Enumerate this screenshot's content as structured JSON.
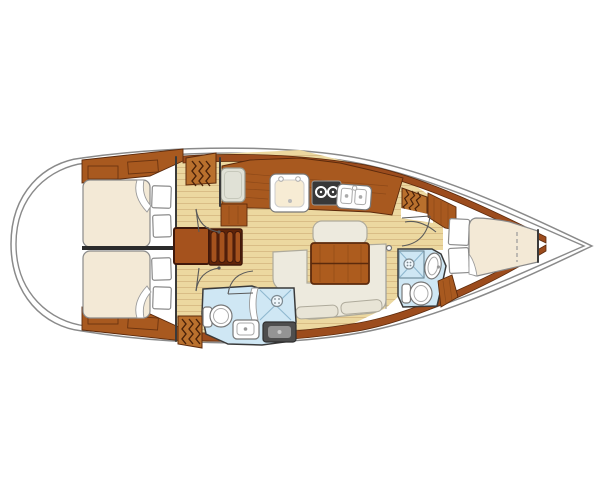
{
  "diagram": {
    "kind": "sailboat-interior-floor-plan",
    "orientation": "bow-right",
    "rooms": [
      {
        "name": "aft-cabin-port",
        "features": [
          "double-berth",
          "pillows",
          "hanging-locker",
          "shelf-lockers"
        ]
      },
      {
        "name": "aft-cabin-starboard",
        "features": [
          "double-berth",
          "pillows",
          "hanging-locker",
          "shelf-lockers"
        ]
      },
      {
        "name": "galley",
        "features": [
          "icebox",
          "single-sink",
          "two-burner-stove",
          "double-sink",
          "counter"
        ]
      },
      {
        "name": "salon",
        "features": [
          "u-shaped-settee",
          "folding-table",
          "bench-cushion"
        ]
      },
      {
        "name": "aft-head",
        "features": [
          "toilet",
          "sink",
          "shower",
          "shower-pan"
        ]
      },
      {
        "name": "forward-head",
        "features": [
          "toilet",
          "sink",
          "shower"
        ]
      },
      {
        "name": "forward-cabin",
        "features": [
          "v-berth",
          "pillows",
          "shelf",
          "hanging-locker"
        ]
      },
      {
        "name": "companionway",
        "features": [
          "stairs"
        ]
      }
    ]
  },
  "palette": {
    "hull_outline": "#8a8a8a",
    "wall": "#3a3a3a",
    "wood_dark": "#9c4c1d",
    "wood_mid": "#a8591f",
    "wood_light": "#b9702d",
    "wood_edge": "#5c2a0c",
    "sole": "#ecd8a0",
    "sole_line": "#d9bd86",
    "mattress": "#f3e9d6",
    "upholstery": "#edeade",
    "upholstery_line": "#aeaa9b",
    "upholstery_slat": "#e8e4d6",
    "pillow": "#ffffff",
    "head_floor": "#cfe7f4",
    "shower_line": "#8fb8cf",
    "stove": "#383838",
    "pan_dark": "#4e4e4e",
    "pan_inner": "#949494",
    "fridge": "#e0e1d6",
    "stairs": "#a5521d",
    "stairs_dark": "#5f2409",
    "table": "#ad5c1e",
    "sink_basin": "#f7ecd4",
    "zigzag": "#4a220a"
  }
}
